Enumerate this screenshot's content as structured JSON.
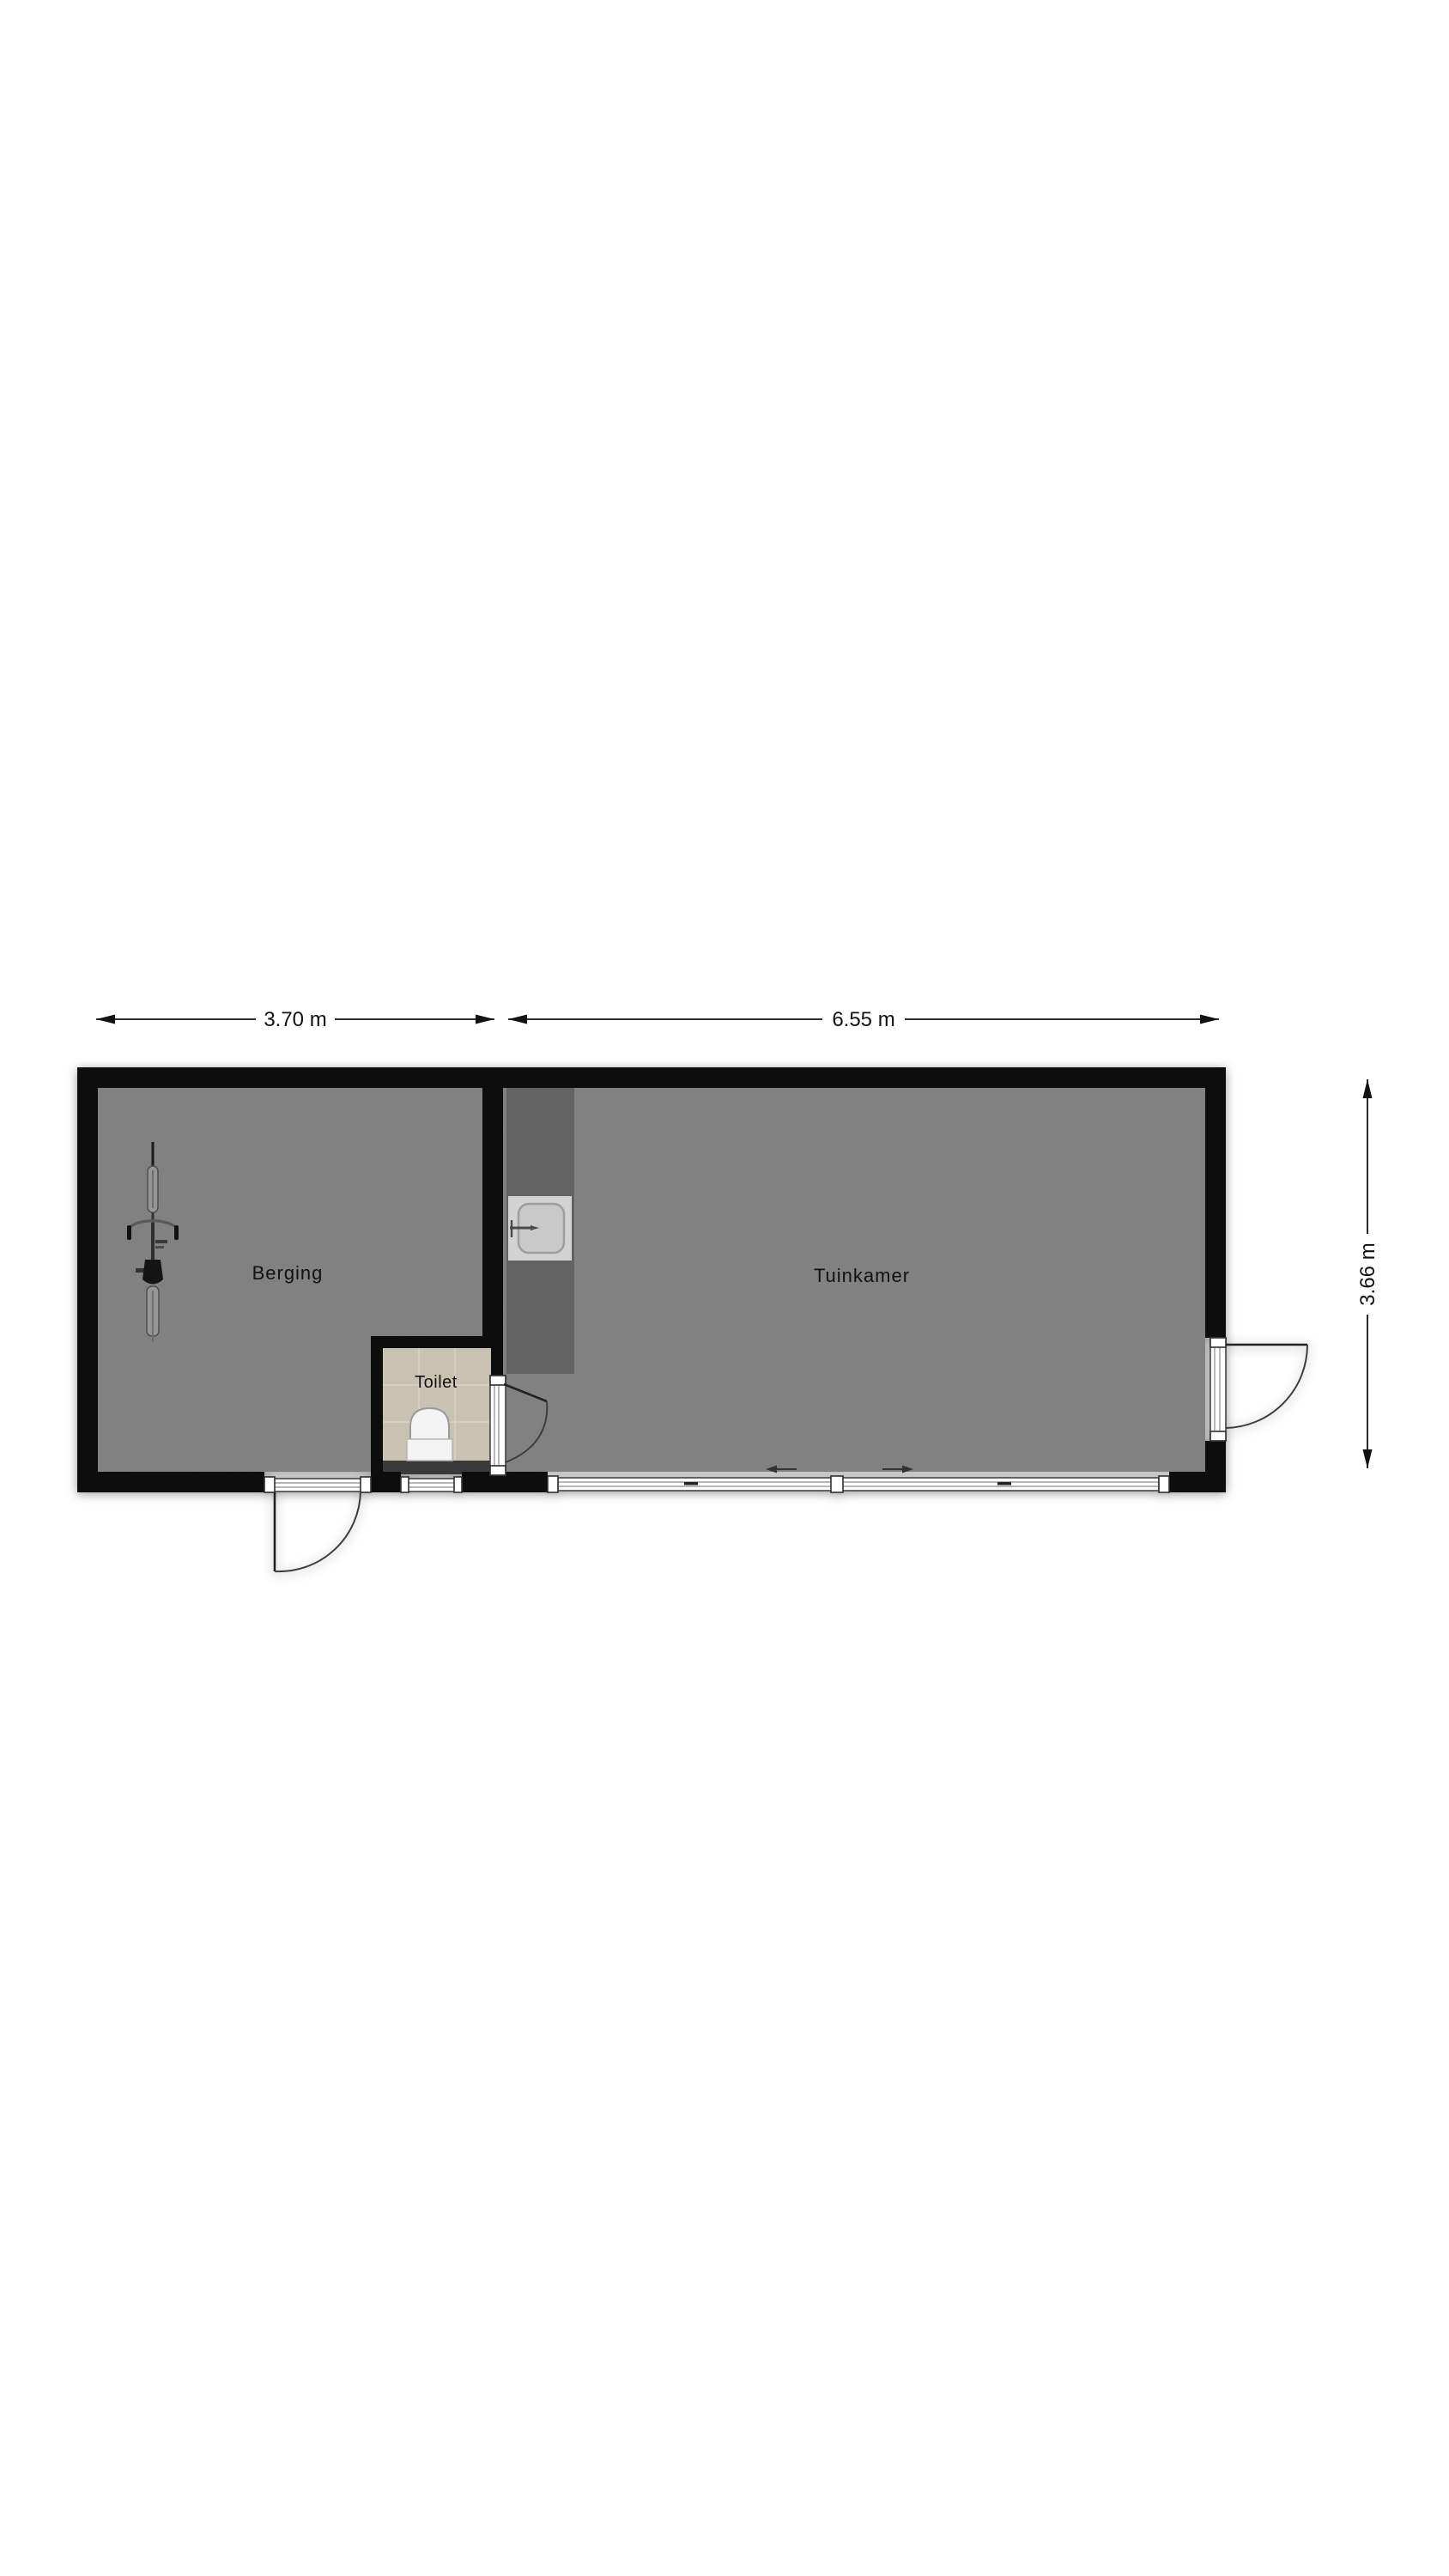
{
  "floorplan": {
    "dimensions": {
      "top_left": "3.70 m",
      "top_right": "6.55 m",
      "right": "3.66 m"
    },
    "rooms": [
      {
        "label": "Berging"
      },
      {
        "label": "Tuinkamer"
      },
      {
        "label": "Toilet"
      }
    ],
    "colors": {
      "wall": "#0d0d0d",
      "floor": "#c7c7c7",
      "counter": "#8f8f8f",
      "sink_surround": "#d3d3d3",
      "sink_basin": "#c9c9c9",
      "toilet_floor": "#c9c2b2",
      "cistern": "#3a3a3a",
      "fixture": "#f4f4f4",
      "text": "#111111"
    },
    "icons": [
      {
        "name": "bicycle-icon"
      },
      {
        "name": "kitchen-sink-icon"
      },
      {
        "name": "toilet-icon"
      },
      {
        "name": "door-swing-icon"
      },
      {
        "name": "sliding-door-icon"
      },
      {
        "name": "window-icon"
      },
      {
        "name": "dimension-arrow-icon"
      }
    ]
  }
}
